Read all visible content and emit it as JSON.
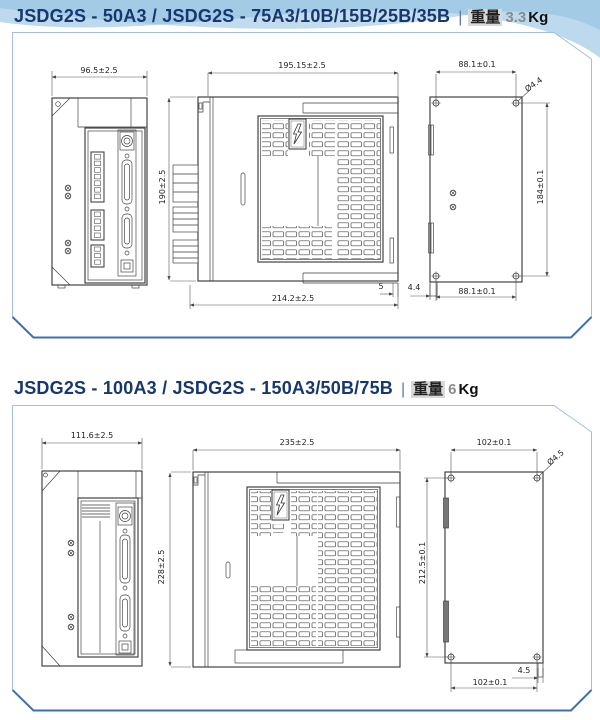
{
  "page": {
    "sections": [
      {
        "title": "JSDG2S - 50A3 / JSDG2S - 75A3/10B/15B/25B/35B",
        "sep": "|",
        "weight_label": "重量",
        "weight_value": "3.3",
        "weight_unit": "Kg",
        "dims": {
          "front_width": "96.5±2.5",
          "side_depth": "195.15±2.5",
          "side_height": "190±2.5",
          "side_total_depth": "214.2±2.5",
          "side_gap": "5",
          "back_foot_offset": "4.4",
          "back_hole_pitch_top": "88.1±0.1",
          "back_hole_dia": "Ø4.4",
          "back_hole_pitch_vertical": "184±0.1",
          "back_hole_pitch_bottom": "88.1±0.1"
        }
      },
      {
        "title": "JSDG2S - 100A3 / JSDG2S - 150A3/50B/75B",
        "sep": "|",
        "weight_label": "重量",
        "weight_value": "6",
        "weight_unit": "Kg",
        "dims": {
          "front_width": "111.6±2.5",
          "side_depth": "235±2.5",
          "side_height": "228±2.5",
          "back_hole_pitch_top": "102±0.1",
          "back_hole_dia": "Ø4.5",
          "back_hole_pitch_vertical": "212.5±0.1",
          "back_foot_offset": "4.5",
          "back_hole_pitch_bottom": "102±0.1"
        }
      }
    ]
  }
}
